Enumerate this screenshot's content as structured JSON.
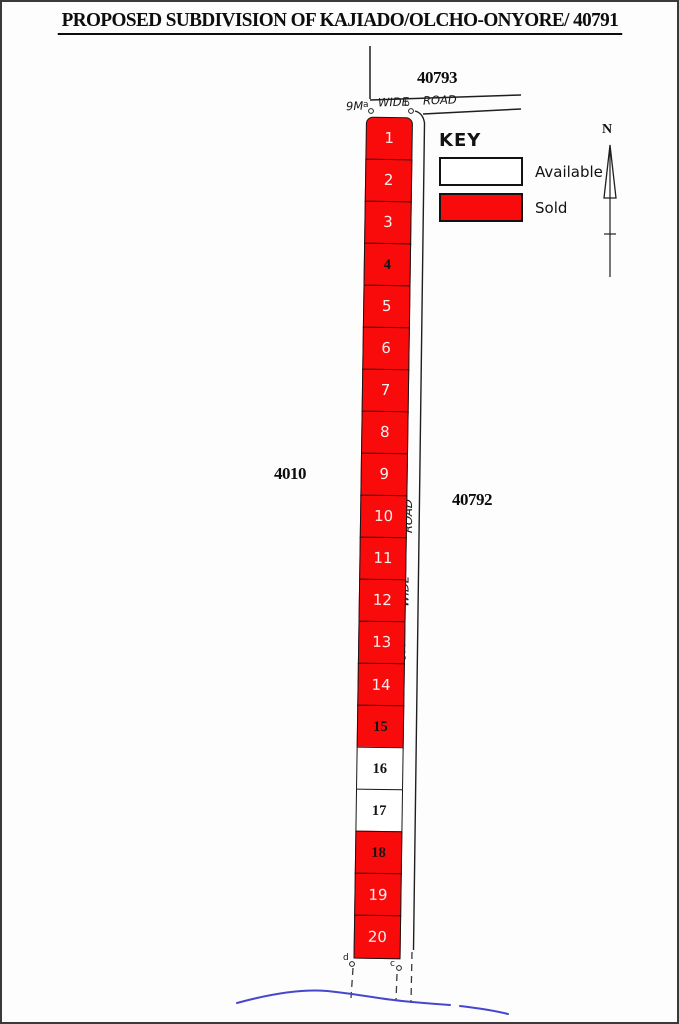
{
  "title": "PROPOSED SUBDIVISION OF KAJIADO/OLCHO-ONYORE/ 40791",
  "parcels": {
    "north": "40793",
    "west": "4010",
    "east": "40792"
  },
  "road_top": {
    "parts": [
      "9M",
      "WIDE",
      "ROAD"
    ]
  },
  "road_side": {
    "parts": [
      "9M",
      "WIDE",
      "ROAD"
    ]
  },
  "beacons": {
    "top_left": "a",
    "top_right": "b",
    "bottom_left": "d",
    "bottom_right": "c"
  },
  "key": {
    "title": "KEY",
    "items": [
      {
        "label": "Available",
        "status": "available"
      },
      {
        "label": "Sold",
        "status": "sold"
      }
    ]
  },
  "north_arrow": {
    "label": "N"
  },
  "colors": {
    "sold": "#f90b0b",
    "available": "#ffffff",
    "stream": "#4747ce",
    "line": "#1f1f1f"
  },
  "plots": [
    {
      "number": "1",
      "status": "sold",
      "text_color": "white"
    },
    {
      "number": "2",
      "status": "sold",
      "text_color": "white"
    },
    {
      "number": "3",
      "status": "sold",
      "text_color": "white"
    },
    {
      "number": "4",
      "status": "sold",
      "text_color": "black"
    },
    {
      "number": "5",
      "status": "sold",
      "text_color": "white"
    },
    {
      "number": "6",
      "status": "sold",
      "text_color": "white"
    },
    {
      "number": "7",
      "status": "sold",
      "text_color": "white"
    },
    {
      "number": "8",
      "status": "sold",
      "text_color": "white"
    },
    {
      "number": "9",
      "status": "sold",
      "text_color": "white"
    },
    {
      "number": "10",
      "status": "sold",
      "text_color": "white"
    },
    {
      "number": "11",
      "status": "sold",
      "text_color": "white"
    },
    {
      "number": "12",
      "status": "sold",
      "text_color": "white"
    },
    {
      "number": "13",
      "status": "sold",
      "text_color": "white"
    },
    {
      "number": "14",
      "status": "sold",
      "text_color": "white"
    },
    {
      "number": "15",
      "status": "sold",
      "text_color": "black"
    },
    {
      "number": "16",
      "status": "available",
      "text_color": "black"
    },
    {
      "number": "17",
      "status": "available",
      "text_color": "black"
    },
    {
      "number": "18",
      "status": "sold",
      "text_color": "black"
    },
    {
      "number": "19",
      "status": "sold",
      "text_color": "white"
    },
    {
      "number": "20",
      "status": "sold",
      "text_color": "white"
    }
  ]
}
